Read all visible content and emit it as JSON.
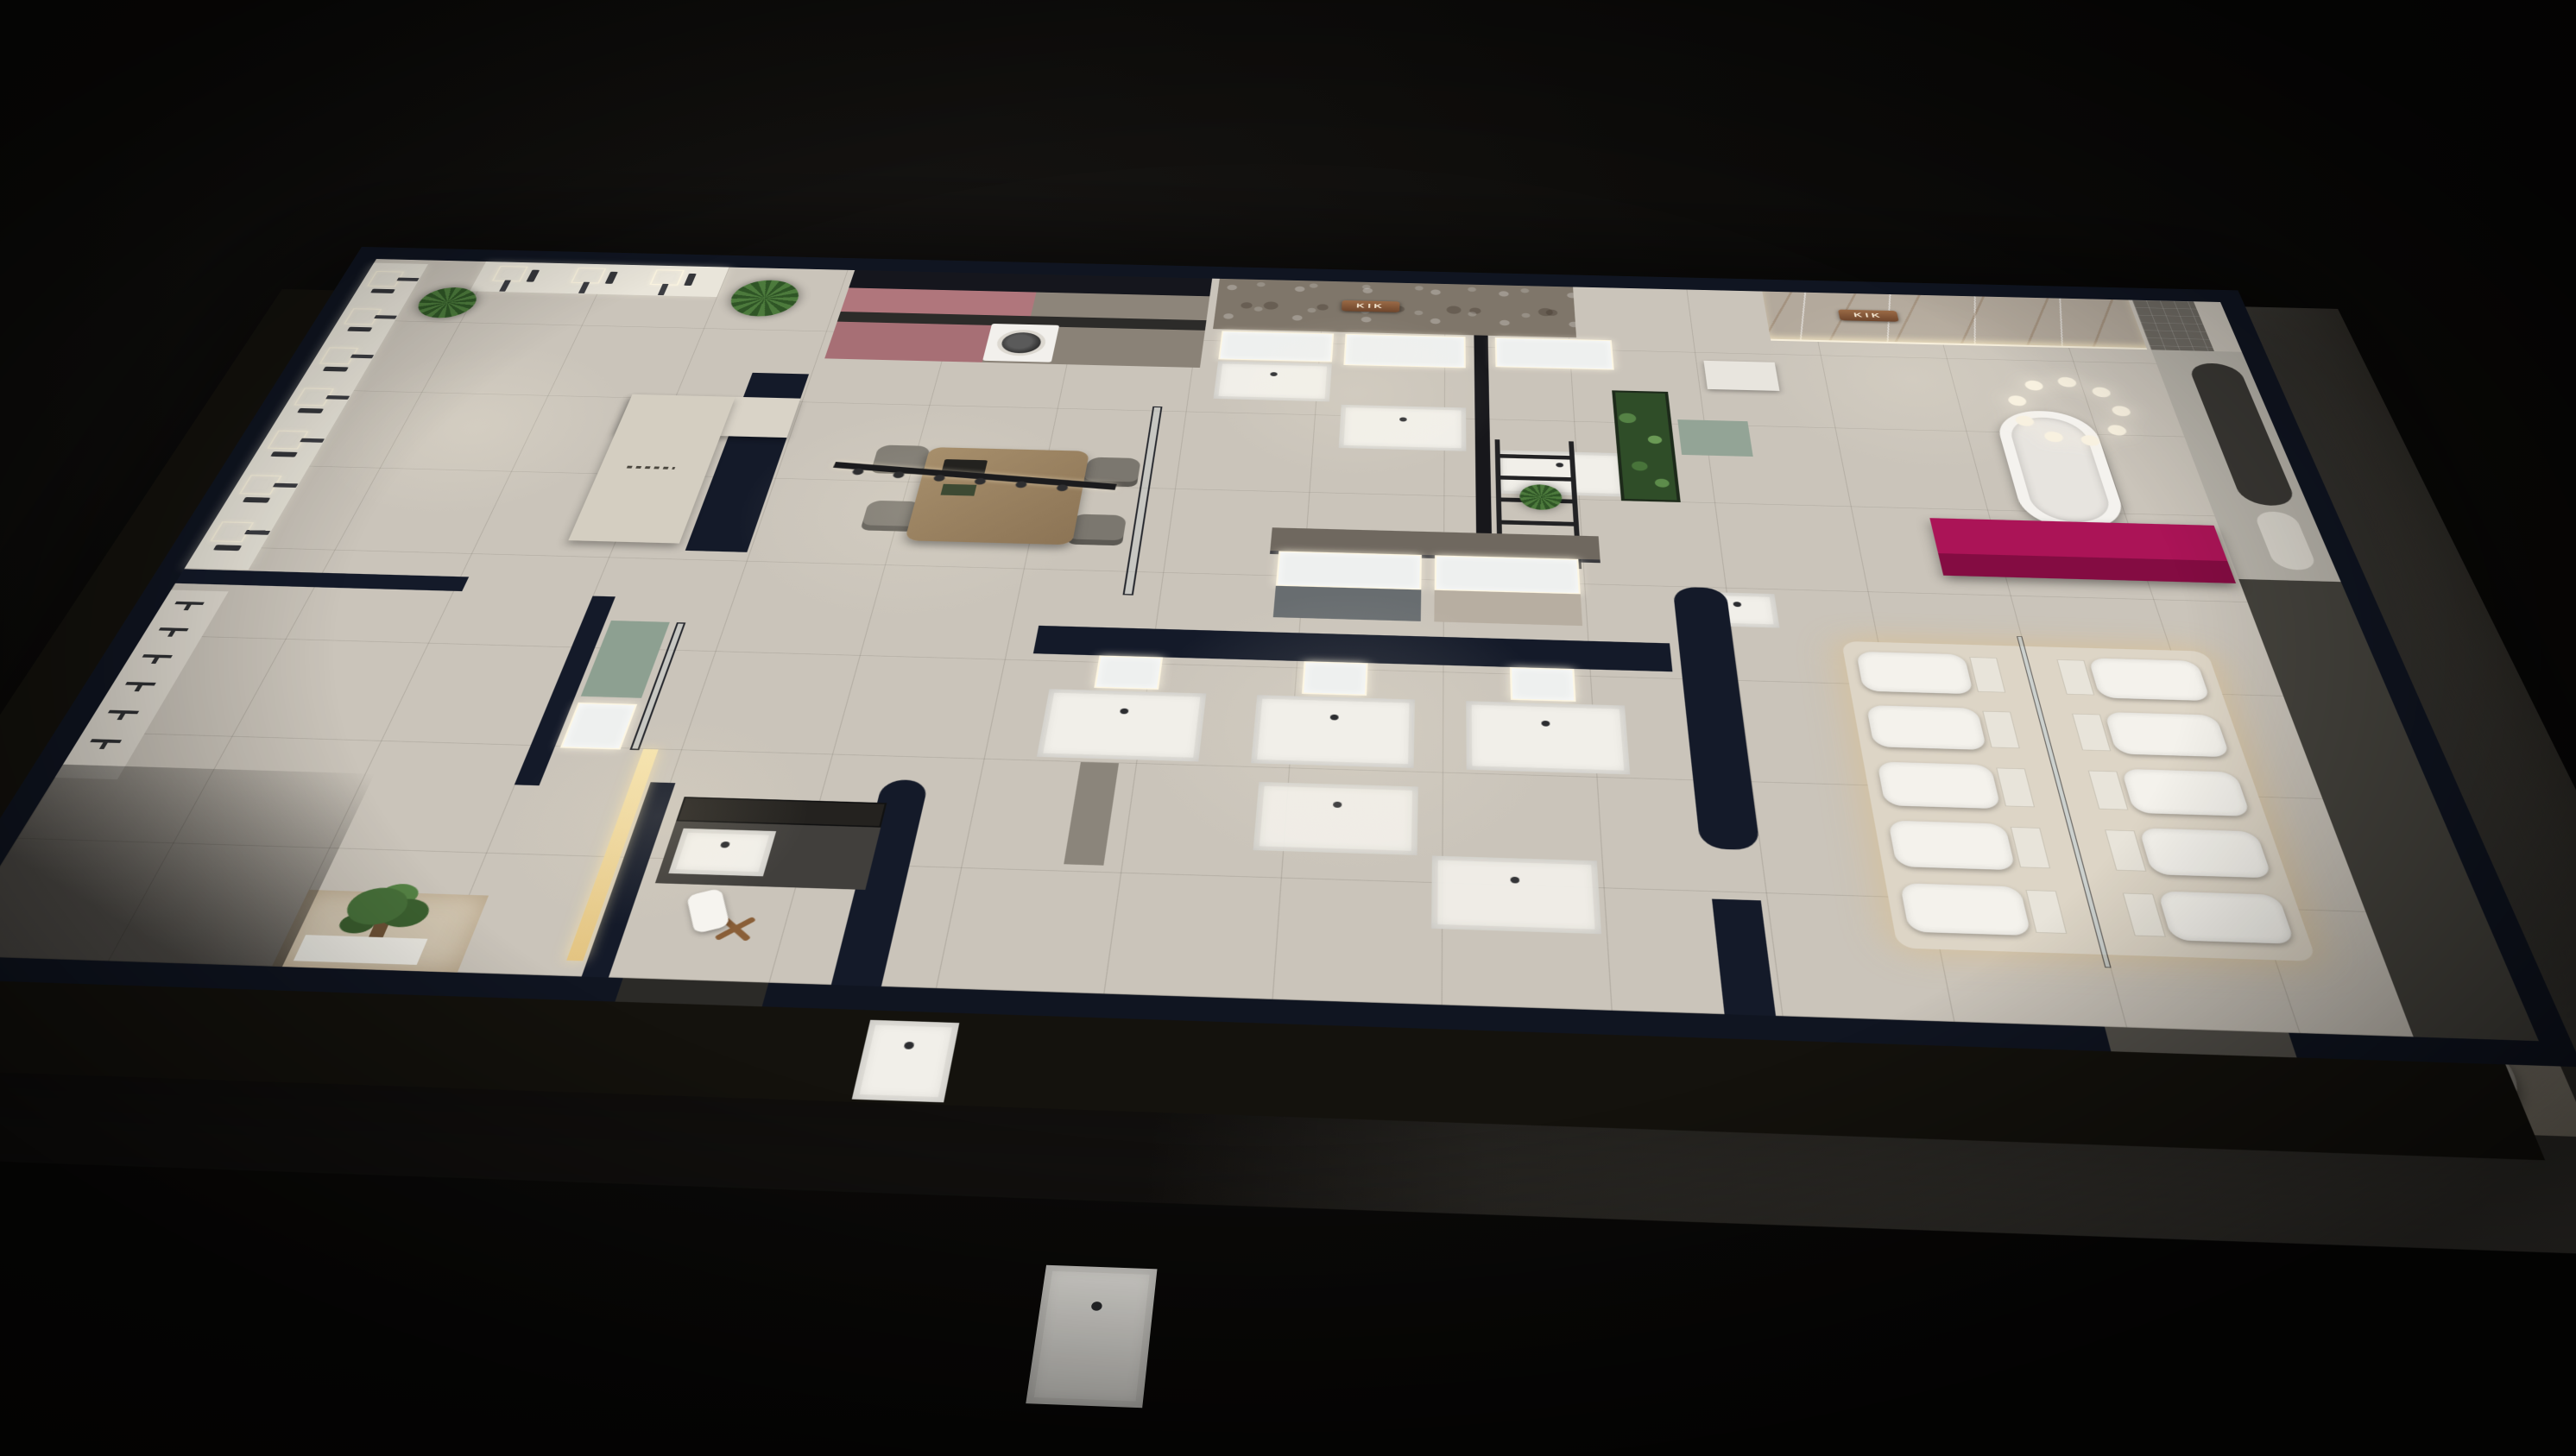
{
  "scene": {
    "type": "3D isometric night render",
    "subject": "KIK bathroom and sanitary-ware showroom, aerial cutaway floor plan",
    "brand": "KIK"
  },
  "signs": {
    "stone_wall_sign": "KIK",
    "marble_wall_sign": "KIK"
  },
  "palette": {
    "backdrop": "#0b0a09",
    "outer_wall": "#101521",
    "floor": "#cac4ba",
    "warm_floor": "#d6cdbd",
    "pavement": "#54514b",
    "stone_wall": "#7f766a",
    "marble_wall": "#b3a99c",
    "accent_magenta": "#a31154",
    "dusty_pink": "#b0767c",
    "sage_green": "#8da091",
    "wood": "#9b8464",
    "plant_green": "#47703a",
    "copper_sign": "#8a5a3c",
    "led_glow": "#f7efdc",
    "fixture_white": "#f2f0ea",
    "charcoal": "#3c3b38"
  },
  "counts": {
    "left_shower_columns": 7,
    "top_shower_columns": 3,
    "faucet_display_rows": 6,
    "toilets": 10,
    "entry_pod_seats": 4,
    "dining_chairs": 4,
    "bottom_row_vanities": 3,
    "top_wall_vanities": 3,
    "island_vanities": 2,
    "chandelier_ring_lights": 12
  }
}
